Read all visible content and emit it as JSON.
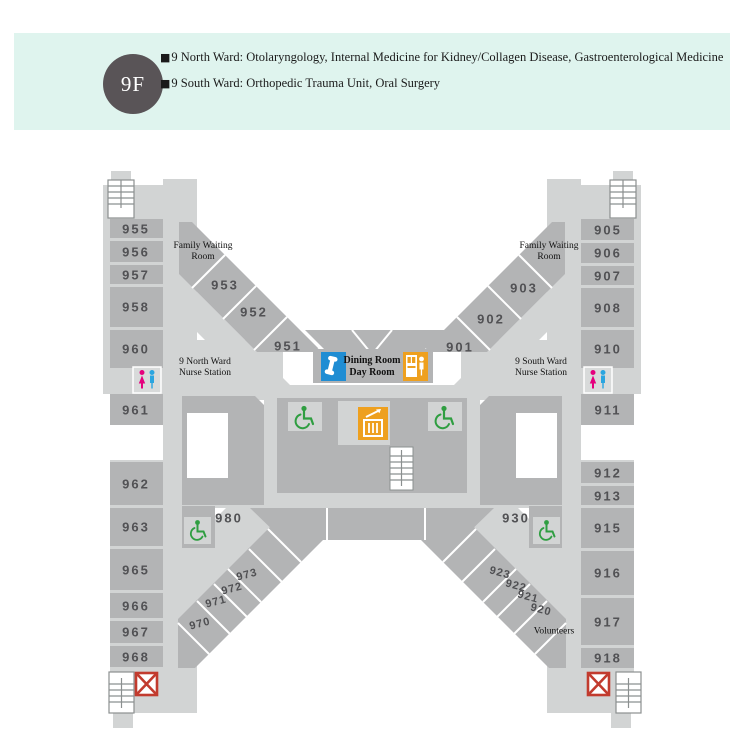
{
  "header": {
    "floor": "9F",
    "lines": [
      {
        "bullet": "■",
        "text": "9 North Ward: Otolaryngology, Internal Medicine for Kidney/Collagen Disease, Gastroenterological Medicine"
      },
      {
        "bullet": "■",
        "text": "9 South Ward: Orthopedic Trauma Unit, Oral Surgery"
      }
    ]
  },
  "rooms": {
    "left": [
      "955",
      "956",
      "957",
      "958",
      "960",
      "961",
      "962",
      "963",
      "965",
      "966",
      "967",
      "968"
    ],
    "right": [
      "905",
      "906",
      "907",
      "908",
      "910",
      "911",
      "912",
      "913",
      "915",
      "916",
      "917",
      "918"
    ],
    "diag_tl": [
      "953",
      "952",
      "951"
    ],
    "diag_tr": [
      "903",
      "902",
      "901"
    ],
    "diag_bl": [
      "973",
      "972",
      "971",
      "970"
    ],
    "diag_br": [
      "923",
      "922",
      "921",
      "920"
    ],
    "special_left": "980",
    "special_right": "930"
  },
  "labels": {
    "family_waiting": {
      "line1": "Family Waiting",
      "line2": "Room"
    },
    "nurse_north": {
      "line1": "9 North Ward",
      "line2": "Nurse Station"
    },
    "nurse_south": {
      "line1": "9 South Ward",
      "line2": "Nurse Station"
    },
    "dining": {
      "line1": "Dining Room",
      "line2": "Day Room"
    },
    "volunteers": "Volunteers"
  },
  "icons": {
    "phone": "public-telephone",
    "vending": "vending-machine",
    "elevator": "elevator",
    "wheelchair": "wheelchair-accessible",
    "restroom": "restroom-men-women",
    "stairs": "stairs",
    "emergency": "emergency-exit-x"
  },
  "colors": {
    "header_band": "#dff4ee",
    "floor_badge": "#595457",
    "room_gray": "#b3b4b5",
    "corridor_gray": "#d2d4d4",
    "phone_blue": "#1f8dd3",
    "vending_orange": "#eea01f",
    "elevator_orange": "#eea01f",
    "wheelchair_green": "#2f9e41",
    "restroom_pink": "#e5007d",
    "restroom_blue": "#2aa5e0",
    "emergency_red": "#c23b2e"
  }
}
